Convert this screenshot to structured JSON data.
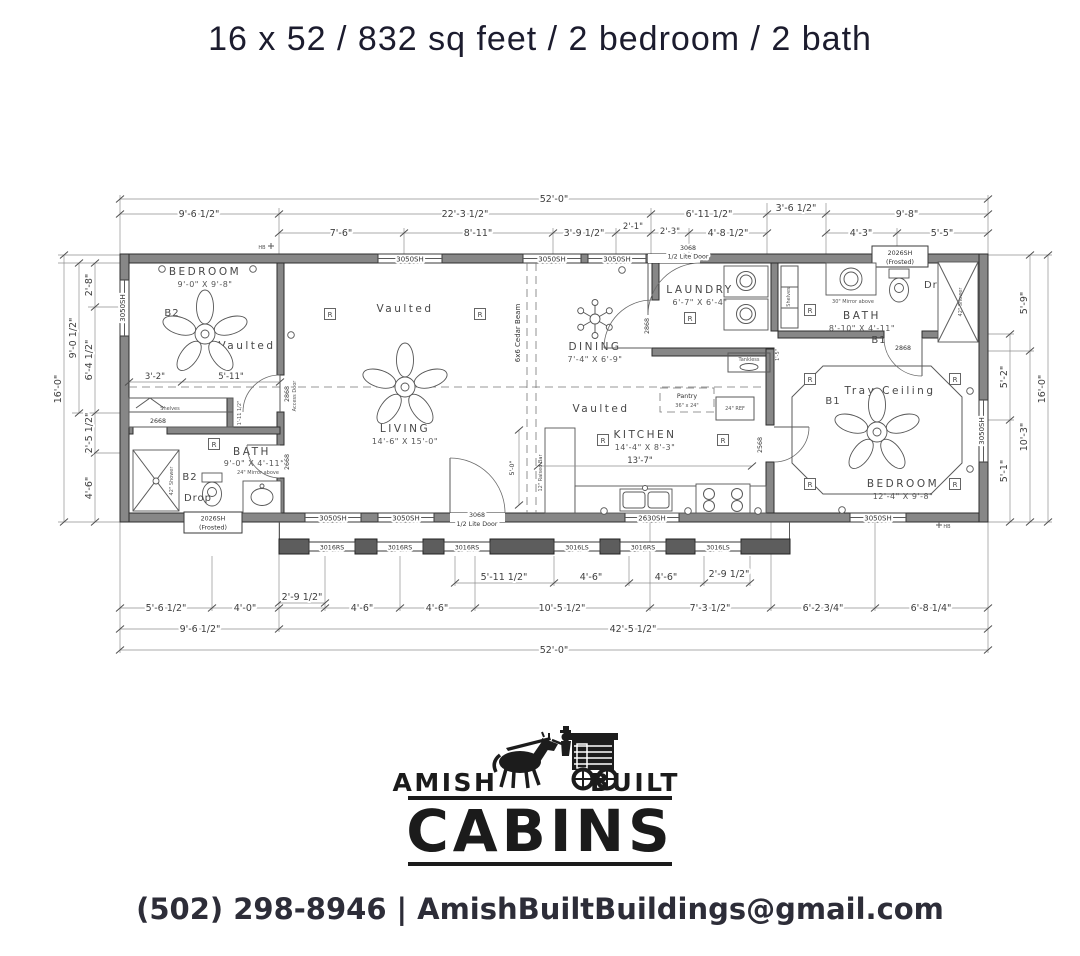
{
  "header": {
    "title": "16 x 52 / 832 sq feet / 2 bedroom / 2 bath"
  },
  "plan": {
    "dims_top": {
      "overall": "52'-0\"",
      "row2": [
        "9'-6 1/2\"",
        "22'-3 1/2\"",
        "6'-11 1/2\"",
        "3'-6 1/2\"",
        "9'-8\""
      ],
      "row3": [
        "7'-6\"",
        "8'-11\"",
        "3'-9 1/2\"",
        "2'-1\"",
        "2'-3\"",
        "4'-8 1/2\"",
        "4'-3\"",
        "5'-5\""
      ]
    },
    "dims_bottom": {
      "row1": [
        "2'-9 1/2\"",
        "5'-11 1/2\"",
        "4'-6\"",
        "4'-6\"",
        "2'-9 1/2\""
      ],
      "row2": [
        "5'-6 1/2\"",
        "4'-0\"",
        "4'-6\"",
        "4'-6\"",
        "10'-5 1/2\"",
        "7'-3 1/2\"",
        "6'-2 3/4\"",
        "6'-8 1/4\""
      ],
      "row3": [
        "9'-6 1/2\"",
        "42'-5 1/2\""
      ],
      "overall": "52'-0\""
    },
    "dims_left": [
      "2'-8\"",
      "9'-0 1/2\"",
      "6'-4 1/2\"",
      "2'-5 1/2\"",
      "4'-6\"",
      "16'-0\""
    ],
    "dims_right": [
      "5'-9\"",
      "5'-2\"",
      "10'-3\"",
      "5'-1\"",
      "16'-0\""
    ],
    "rooms": {
      "bedroom2": {
        "name": "BEDROOM",
        "size": "9'-0\" X 9'-8\""
      },
      "living": {
        "name": "LIVING",
        "size": "14'-6\" X 15'-0\""
      },
      "dining": {
        "name": "DINING",
        "size": "7'-4\" X 6'-9\""
      },
      "kitchen": {
        "name": "KITCHEN",
        "size": "14'-4\" X 8'-3\""
      },
      "laundry": {
        "name": "LAUNDRY",
        "size": "6'-7\" X 6'-4\""
      },
      "bath1": {
        "name": "BATH",
        "size": "8'-10\" X 4'-11\""
      },
      "bath2": {
        "name": "BATH",
        "size": "9'-0\" X 4'-11\""
      },
      "bedroom1": {
        "name": "BEDROOM",
        "size": "12'-4\" X 9'-8\""
      }
    },
    "labels": {
      "vaulted": "Vaulted",
      "tray_ceiling": "Tray Ceiling",
      "b1": "B1",
      "b2": "B2",
      "drop": "Drop",
      "cedar_beam": "6x6 Cedar Beam",
      "raised_bar": "12\" Raised Bar",
      "bar_dim": "5'-0\"",
      "pantry": "Pantry",
      "pantry_size": "36\" x 24\"",
      "ref": "24\" REF",
      "tankless": "Tankless",
      "shelves": "Shelves",
      "mirror24": "24\" Mirror above",
      "mirror30": "30\" Mirror above",
      "shower42": "42\" Shower",
      "dim_3_2": "3'-2\"",
      "dim_5_11": "5'-11\"",
      "dim_13_7": "13'-7\"",
      "dim_1_5": "1'-5\"",
      "dim_1_11": "1'-11 1/2\"",
      "recessed": "R",
      "hb": "HB"
    },
    "windows": {
      "w3050": "3050SH",
      "w2630": "2630SH",
      "w2026": "2026SH",
      "frosted": "(Frosted)",
      "w3016rs": "3016RS",
      "w3016ls": "3016LS"
    },
    "doors": {
      "d3068": "3068",
      "lite": "1/2 Lite Door",
      "d2868": "2868",
      "d2668": "2668",
      "d2568": "2568",
      "access": "Access Door"
    }
  },
  "logo": {
    "amish": "AMISH",
    "built": "BUILT",
    "cabins": "CABINS"
  },
  "contact": {
    "phone": "(502) 298-8946",
    "separator": "|",
    "email": "AmishBuiltBuildings@gmail.com"
  }
}
